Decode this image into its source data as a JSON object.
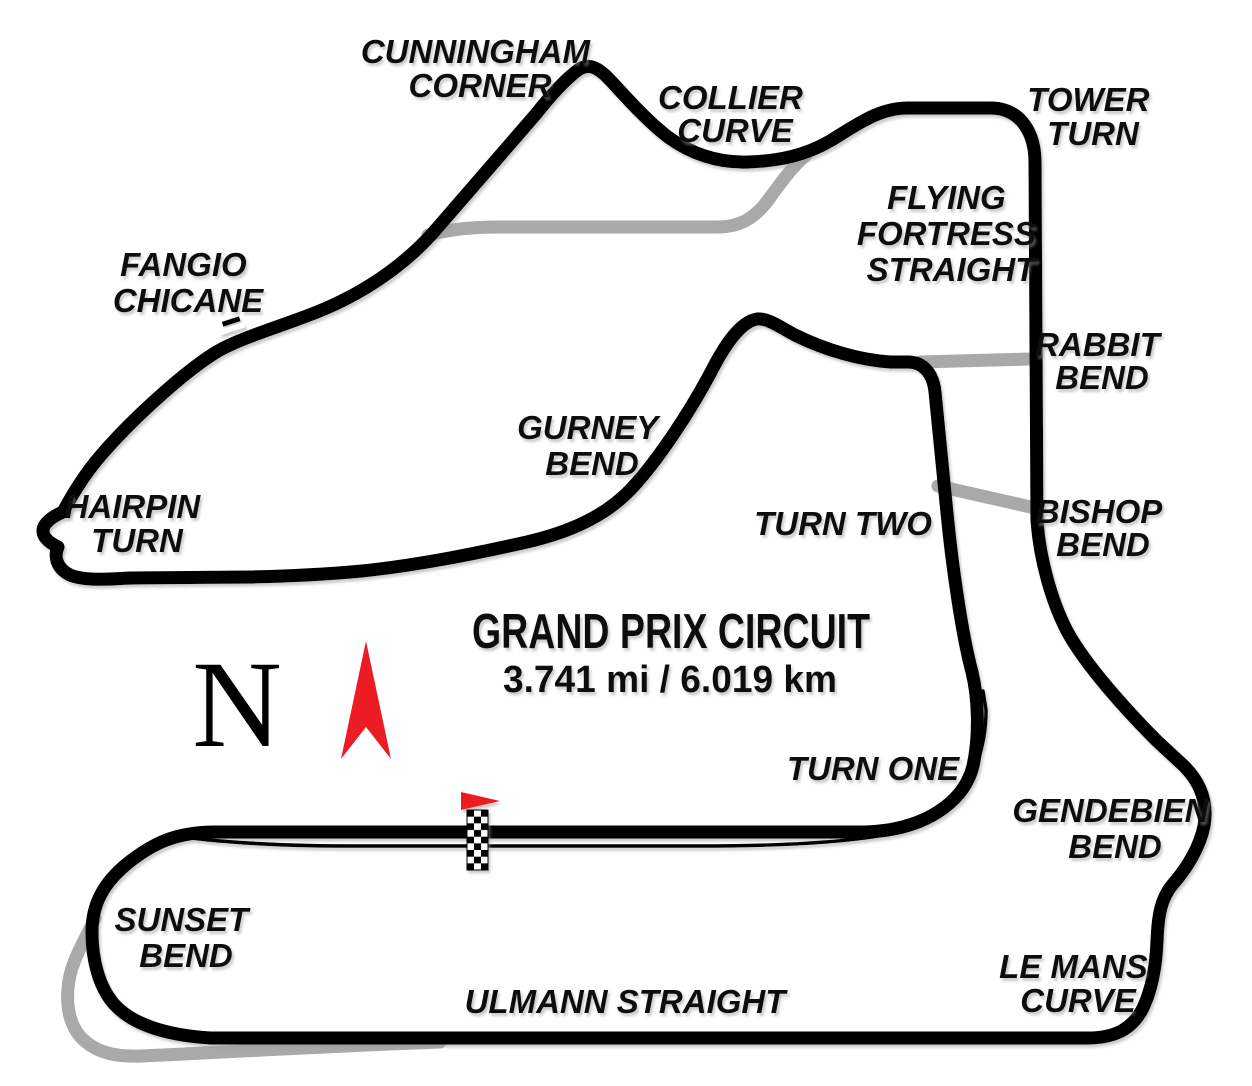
{
  "map": {
    "title": "GRAND PRIX CIRCUIT",
    "length_label": "3.741 mi / 6.019 km",
    "north_letter": "N",
    "colors": {
      "track": "#000000",
      "alternate_track": "#a9a9a9",
      "flag_red": "#ec1c24",
      "shadow": "#999999",
      "background": "#ffffff"
    },
    "labels": {
      "cunningham_corner": [
        "CUNNINGHAM",
        "CORNER"
      ],
      "collier_curve": [
        "COLLIER",
        "CURVE"
      ],
      "tower_turn": [
        "TOWER",
        "TURN"
      ],
      "flying_fortress_straight": [
        "FLYING",
        "FORTRESS",
        "STRAIGHT"
      ],
      "rabbit_bend": [
        "RABBIT",
        "BEND"
      ],
      "bishop_bend": [
        "BISHOP",
        "BEND"
      ],
      "fangio_chicane": [
        "FANGIO",
        "CHICANE"
      ],
      "gurney_bend": [
        "GURNEY",
        "BEND"
      ],
      "hairpin_turn": [
        "HAIRPIN",
        "TURN"
      ],
      "turn_two": [
        "TURN TWO"
      ],
      "turn_one": [
        "TURN ONE"
      ],
      "gendebien_bend": [
        "GENDEBIEN",
        "BEND"
      ],
      "le_mans_curve": [
        "LE MANS",
        "CURVE"
      ],
      "sunset_bend": [
        "SUNSET",
        "BEND"
      ],
      "ulmann_straight": [
        "ULMANN STRAIGHT"
      ]
    }
  }
}
